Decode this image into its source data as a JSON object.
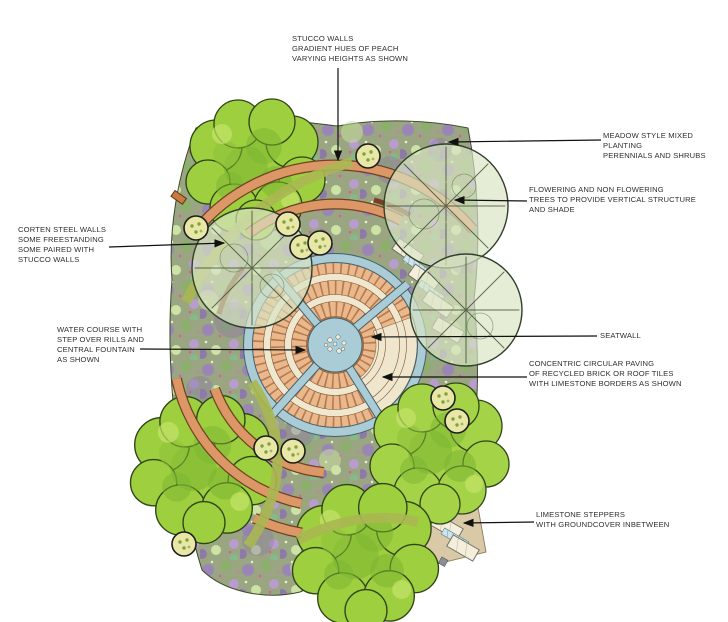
{
  "drawing": {
    "type": "landscape-architecture-plan",
    "background": "#ffffff"
  },
  "annotations": [
    {
      "id": "stucco-walls",
      "text": "STUCCO WALLS\nGRADIENT HUES OF PEACH\nVARYING HEIGHTS AS SHOWN"
    },
    {
      "id": "meadow-planting",
      "text": "MEADOW STYLE MIXED PLANTING\nPERENNIALS AND SHRUBS"
    },
    {
      "id": "flowering-trees",
      "text": "FLOWERING AND NON FLOWERING\nTREES TO PROVIDE VERTICAL STRUCTURE\nAND SHADE"
    },
    {
      "id": "corten-walls",
      "text": "CORTEN STEEL WALLS\nSOME FREESTANDING\nSOME PAIRED WITH\nSTUCCO WALLS"
    },
    {
      "id": "water-course",
      "text": "WATER COURSE WITH\nSTEP OVER RILLS AND\nCENTRAL FOUNTAIN\nAS SHOWN"
    },
    {
      "id": "seatwall",
      "text": "SEATWALL"
    },
    {
      "id": "circular-paving",
      "text": "CONCENTRIC CIRCULAR PAVING\nOF RECYCLED BRICK OR ROOF TILES\nWITH LIMESTONE BORDERS AS SHOWN"
    },
    {
      "id": "limestone-steppers",
      "text": "LIMESTONE STEPPERS\nWITH GROUNDCOVER INBETWEEN"
    }
  ],
  "palette": {
    "stucco_wall_peach": "#dd9767",
    "wall_outline": "#6b4423",
    "corten_rust": "#7a3f23",
    "brick_paving": "#e9b88c",
    "brick_joint": "#b9794e",
    "limestone": "#f0e7cf",
    "water_blue": "#a9ccd6",
    "water_edge": "#44606a",
    "tree_canopy": "#9ecf3f",
    "tree_canopy_dark": "#7cb531",
    "translucent_tree": "#d9e4c4",
    "olive_path": "#aab752",
    "meadow_base": "#9aa581",
    "meadow_purple": "#9a86b5",
    "meadow_green": "#8ab069",
    "meadow_pink": "#e05a9e",
    "topiary": "#e9e7a6",
    "plaza_tan": "#d9c9a6",
    "leader_line": "#111111",
    "annotation_text": "#2f2f2f"
  }
}
